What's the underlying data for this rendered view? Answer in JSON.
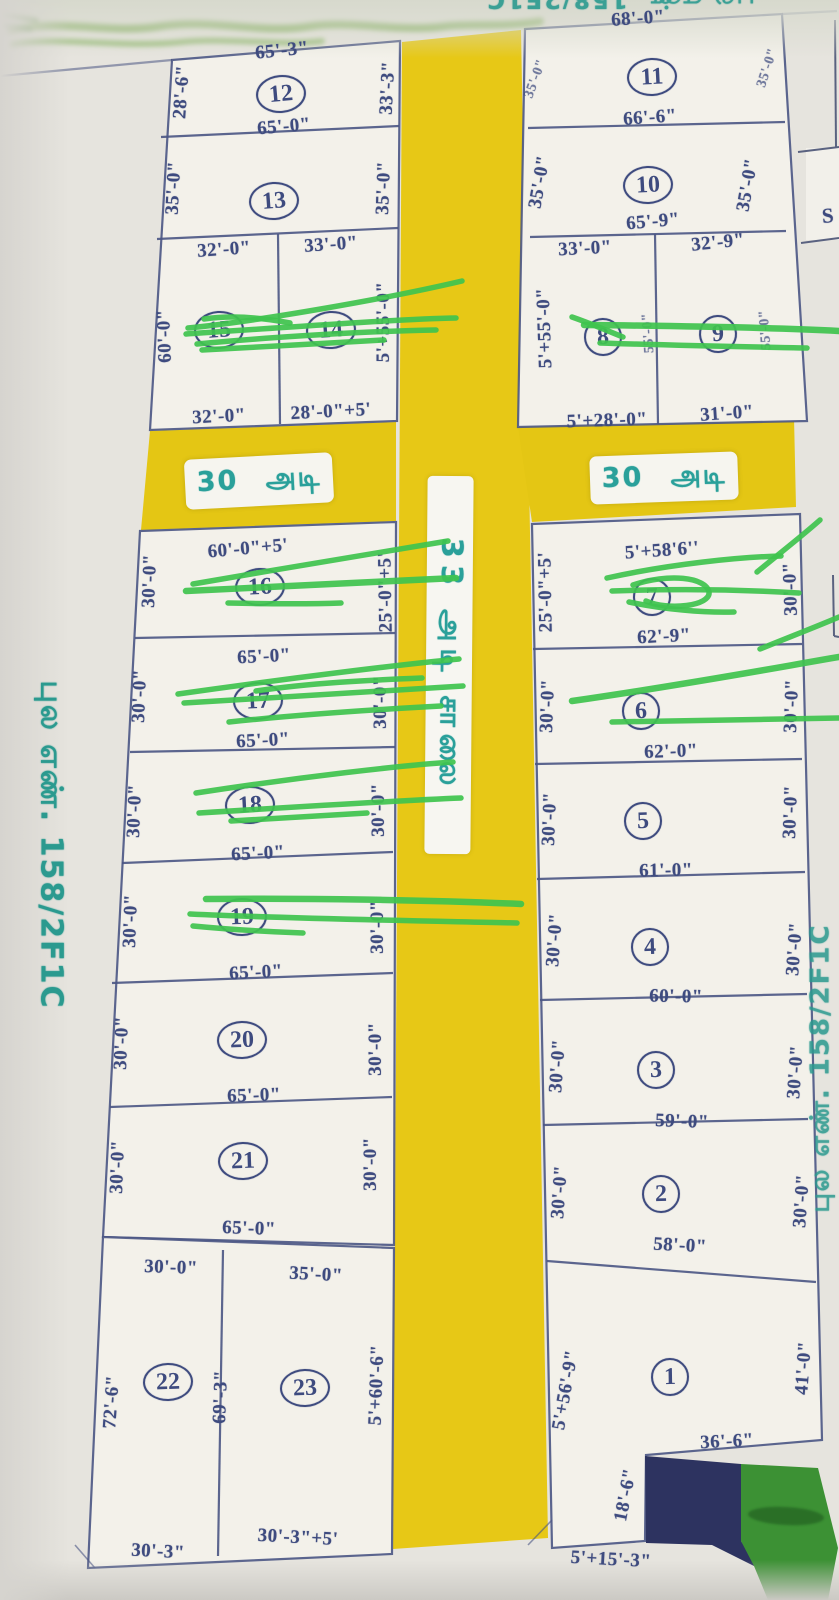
{
  "margins": {
    "left_survey_no": "புல எண். 158/2F1C",
    "right_survey_no": "புல எண். 158/2F1C",
    "top_right_partial": "புல எண். 158/2F1C",
    "corner_letter": "S"
  },
  "roads": {
    "main_label": "33 அடி சாலை",
    "cross_left_label": "30 அடி",
    "cross_right_label": "30 அடி"
  },
  "colors": {
    "road_yellow": "#e7c816",
    "marker_green": "#3fc44f",
    "ink_blue": "#3e4b7f",
    "teal": "#2aa09a",
    "navy_shape": "#2d3360",
    "green_shape": "#3c9134"
  },
  "plots": {
    "p1": {
      "number": "1",
      "left": "5'+56'-9\"",
      "right": "41'-0\"",
      "inner_width": "36'-6\"",
      "inner_height": "18'-6\"",
      "bottom": "5'+15'-3\""
    },
    "p2": {
      "number": "2",
      "left": "30'-0\"",
      "right": "30'-0\"",
      "bottom": "58'-0\""
    },
    "p3": {
      "number": "3",
      "left": "30'-0\"",
      "right": "30'-0\"",
      "bottom": "59'-0\""
    },
    "p4": {
      "number": "4",
      "left": "30'-0\"",
      "right": "30'-0\"",
      "bottom": "60'-0\""
    },
    "p5": {
      "number": "5",
      "left": "30'-0\"",
      "right": "30'-0\"",
      "bottom": "61'-0\""
    },
    "p6": {
      "number": "6",
      "left": "30'-0\"",
      "right": "30'-0\"",
      "bottom": "62'-0\""
    },
    "p7": {
      "number": "7",
      "top": "5'+58'6''",
      "left": "25'-0\"+5'",
      "right": "30'-0\"",
      "bottom": "62'-9\""
    },
    "p8": {
      "number": "8",
      "top": "33'-0\"",
      "left": "5'+55'-0\"",
      "inner": "55'-0\"",
      "bottom": "5'+28'-0\""
    },
    "p9": {
      "number": "9",
      "top": "32'-9\"",
      "right": "55'-0\"",
      "bottom": "31'-0\""
    },
    "p10": {
      "number": "10",
      "left": "35'-0\"",
      "right": "35'-0\"",
      "bottom": "65'-9\""
    },
    "p11": {
      "number": "11",
      "top": "68'-0\"",
      "left": "35'-0\"",
      "right": "35'-0\"",
      "bottom": "66'-6\""
    },
    "p12": {
      "number": "12",
      "top": "65'-3\"",
      "left": "28'-6\"",
      "right": "33'-3\"",
      "bottom": "65'-0\""
    },
    "p13": {
      "number": "13",
      "left": "35'-0\"",
      "right": "35'-0\""
    },
    "p14": {
      "number": "14",
      "top": "33'-0\"",
      "right": "5'+55'-0\"",
      "bottom": "28'-0\"+5'"
    },
    "p15": {
      "number": "15",
      "top": "32'-0\"",
      "left": "60'-0\"",
      "bottom": "32'-0\""
    },
    "p16": {
      "number": "16",
      "top": "60'-0\"+5'",
      "left": "30'-0\"",
      "right": "25'-0\"+5'"
    },
    "p17": {
      "number": "17",
      "top": "65'-0\"",
      "left": "30'-0\"",
      "right": "30'-0\"",
      "bottom": "65'-0\""
    },
    "p18": {
      "number": "18",
      "left": "30'-0\"",
      "right": "30'-0\"",
      "bottom": "65'-0\""
    },
    "p19": {
      "number": "19",
      "left": "30'-0\"",
      "right": "30'-0\"",
      "bottom": "65'-0\""
    },
    "p20": {
      "number": "20",
      "left": "30'-0\"",
      "right": "30'-0\"",
      "bottom": "65'-0\""
    },
    "p21": {
      "number": "21",
      "left": "30'-0\"",
      "right": "30'-0\"",
      "bottom": "65'-0\""
    },
    "p22": {
      "number": "22",
      "top": "30'-0\"",
      "left": "72'-6\"",
      "right": "69'-3\"",
      "bottom": "30'-3\""
    },
    "p23": {
      "number": "23",
      "top": "35'-0\"",
      "right": "5'+60'-6\"",
      "bottom": "30'-3\"+5'"
    }
  }
}
